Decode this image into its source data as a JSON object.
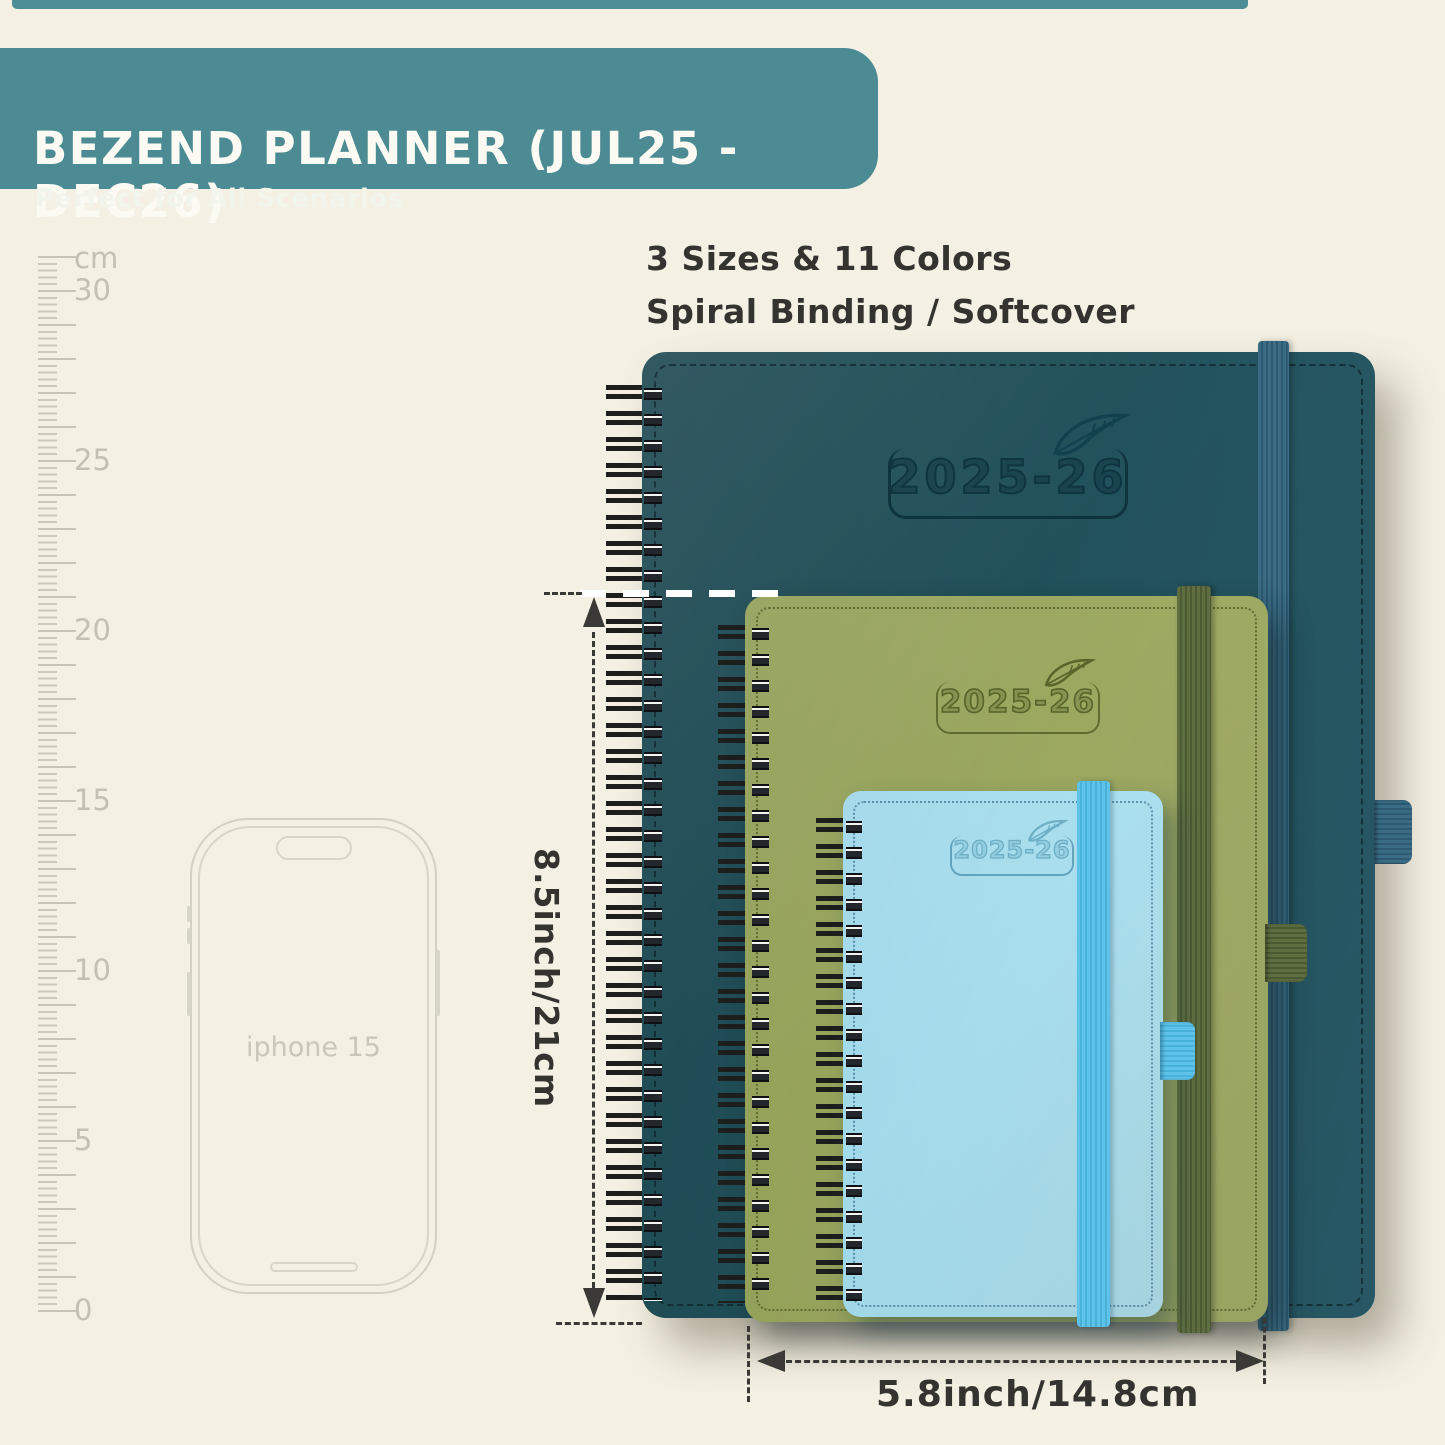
{
  "colors": {
    "background": "#f4f0e3",
    "banner_teal": "#4c8b93",
    "text_charcoal": "#34332f",
    "ruler_gray": "#c3c0b4",
    "cover_large": "#215059",
    "cover_medium": "#9da961",
    "cover_small": "#a9dfee",
    "band_large": "#3a6c85",
    "band_medium": "#5e6e41",
    "band_small": "#5fc3e9"
  },
  "banner": {
    "title": "BEZEND PLANNER (JUL25 - DEC26)",
    "subtitle": "Perfect for All Scenarios"
  },
  "note": {
    "line1": "3 Sizes & 11 Colors",
    "line2": "Spiral Binding / Softcover"
  },
  "ruler": {
    "unit": "cm",
    "labels": [
      "30",
      "25",
      "20",
      "15",
      "10",
      "5",
      "0"
    ]
  },
  "phone": {
    "label": "iphone 15"
  },
  "planners": [
    {
      "size": "large",
      "year": "2025-26"
    },
    {
      "size": "medium",
      "year": "2025-26"
    },
    {
      "size": "small",
      "year": "2025-26"
    }
  ],
  "dimensions": {
    "height_label": "8.5inch/21cm",
    "width_label": "5.8inch/14.8cm"
  }
}
